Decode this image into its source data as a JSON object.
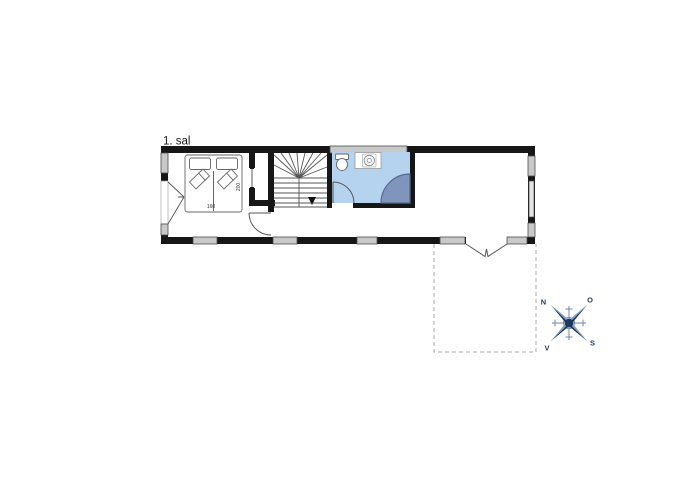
{
  "colors": {
    "background": "#ffffff",
    "wall": "#161616",
    "window_fill": "#c9c9c9",
    "window_fill_light": "#e2e2e2",
    "window_stroke": "#4d4d4d",
    "bathroom_fill": "#b5d2ee",
    "shower_fill": "#8195bc",
    "shower_stroke": "#55698f",
    "furniture_stroke": "#666666",
    "thin_line": "#555555",
    "terrace_dash": "#aaaaaa",
    "compass_navy": "#1b3a5e",
    "compass_light": "#7189ac",
    "compass_light2": "#8aa2c2",
    "label_text": "#1a1a1a"
  },
  "floor_plan": {
    "label": "1. sal",
    "bed": {
      "width_label": "160",
      "length_label": "200"
    },
    "compass": {
      "north": "N",
      "east": "O",
      "south": "S",
      "west": "V"
    }
  }
}
